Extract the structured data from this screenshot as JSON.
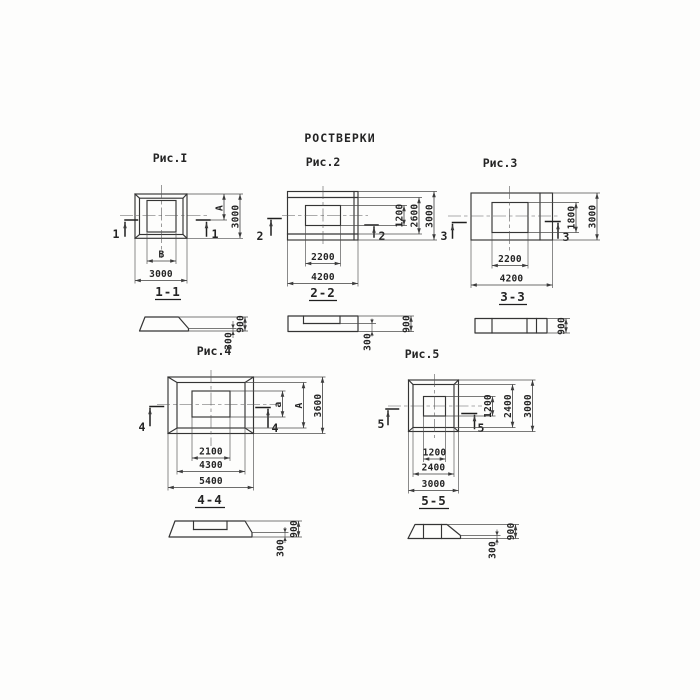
{
  "page": {
    "title": "РОСТВЕРКИ",
    "background": "#fdfdfc",
    "line_color": "#343434"
  },
  "figures": [
    {
      "label": "Рис.I",
      "cut": "1",
      "section": "1-1",
      "dims": {
        "bottom": [
          "В",
          "3000"
        ],
        "right": [
          "А",
          "3000"
        ],
        "section": [
          "300",
          "900"
        ]
      }
    },
    {
      "label": "Рис.2",
      "cut": "2",
      "section": "2-2",
      "dims": {
        "bottom": [
          "2200",
          "4200"
        ],
        "right": [
          "1200",
          "2600",
          "3000"
        ],
        "section": [
          "300",
          "900"
        ]
      }
    },
    {
      "label": "Рис.3",
      "cut": "3",
      "section": "3-3",
      "dims": {
        "bottom": [
          "2200",
          "4200"
        ],
        "right": [
          "1800",
          "3000"
        ],
        "section": [
          "900"
        ]
      }
    },
    {
      "label": "Рис.4",
      "cut": "4",
      "section": "4-4",
      "dims": {
        "bottom": [
          "2100",
          "4300",
          "5400"
        ],
        "right": [
          "а",
          "А",
          "3600"
        ],
        "section": [
          "300",
          "900"
        ]
      }
    },
    {
      "label": "Рис.5",
      "cut": "5",
      "section": "5-5",
      "dims": {
        "bottom": [
          "1200",
          "2400",
          "3000"
        ],
        "right": [
          "1200",
          "2400",
          "3000"
        ],
        "section": [
          "300",
          "900"
        ]
      }
    }
  ]
}
